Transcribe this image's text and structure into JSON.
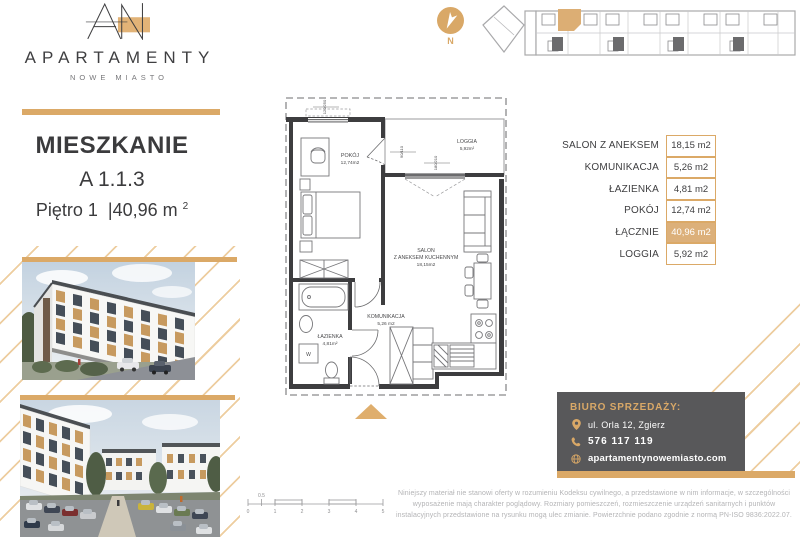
{
  "brand": {
    "name": "APARTAMENTY",
    "subtitle": "NOWE MIASTO"
  },
  "listing": {
    "heading": "MIESZKANIE",
    "unit": "A 1.1.3",
    "floor": "Piętro 1",
    "separator": "|",
    "area": "40,96 m",
    "area_exp": "2"
  },
  "compass": {
    "north_label": "N"
  },
  "floorplan": {
    "pokoj_name": "POKÓJ",
    "pokoj_area": "12,74m2",
    "loggia_name": "LOGGIA",
    "loggia_area": "5,92m²",
    "salon_line1": "SALON",
    "salon_line2": "Z ANEKSEM KUCHENNYM",
    "salon_area": "18,15m2",
    "komunikacja_name": "KOMUNIKACJA",
    "komunikacja_area": "5,26 m2",
    "lazienka_name": "ŁAZIENKA",
    "lazienka_area": "4,81m²",
    "washer_label": "W",
    "dim_pokoj_window": "120/250",
    "dim_loggia_door": "90/110",
    "dim_salon_window": "180/210"
  },
  "area_table": {
    "rows": [
      {
        "label": "SALON Z ANEKSEM",
        "value": "18,15 m2"
      },
      {
        "label": "KOMUNIKACJA",
        "value": "5,26 m2"
      },
      {
        "label": "ŁAZIENKA",
        "value": "4,81 m2"
      },
      {
        "label": "POKÓJ",
        "value": "12,74 m2"
      },
      {
        "label": "ŁĄCZNIE",
        "value": "40,96 m2"
      },
      {
        "label": "LOGGIA",
        "value": "5,92 m2"
      }
    ]
  },
  "sales_office": {
    "heading": "BIURO SPRZEDAŻY:",
    "address": "ul. Orla 12, Zgierz",
    "phone": "576 117 119",
    "website": "apartamentynowemiasto.com"
  },
  "scale_bar": {
    "ticks": [
      "0",
      "0.5",
      "1",
      "2",
      "3",
      "4",
      "5"
    ]
  },
  "disclaimer": "Niniejszy materiał nie stanowi oferty w rozumieniu Kodeksu cywilnego, a przedstawione w nim informacje, w szczególności wyposażenie mają charakter poglądowy. Rozmiary pomieszczeń, rozmieszczenie urządzeń sanitarnych i punktów instalacyjnych przedstawione na rysunku mogą ulec zmianie. Powierzchnie podano zgodnie z normą PN-ISO 9836:2022.07.",
  "colors": {
    "accent": "#dba967",
    "accent_light": "#edcd9f",
    "highlight_fill": "#dcb07a",
    "dark_panel": "#58585a",
    "text_dark": "#3b3b3d"
  }
}
